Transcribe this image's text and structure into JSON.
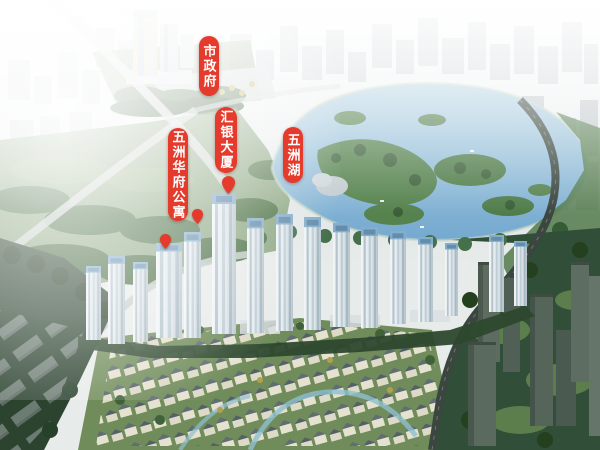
{
  "annotations": [
    {
      "id": "city-government",
      "text": "市政府"
    },
    {
      "id": "huiyin-tower",
      "text": "汇银大厦"
    },
    {
      "id": "wuzhou-huafu-apartment",
      "text": "五洲华府公寓"
    },
    {
      "id": "wuzhou-lake",
      "text": "五洲湖"
    }
  ],
  "colors": {
    "label-bg": "#e43b2c",
    "label-text": "#ffffff",
    "pin-color": "#e43b2c",
    "lake-blue": "#74a9cf",
    "haze-white": "#f3f5f6",
    "park-green": "#7e9b70",
    "dark-tree-green": "#2c4330"
  }
}
